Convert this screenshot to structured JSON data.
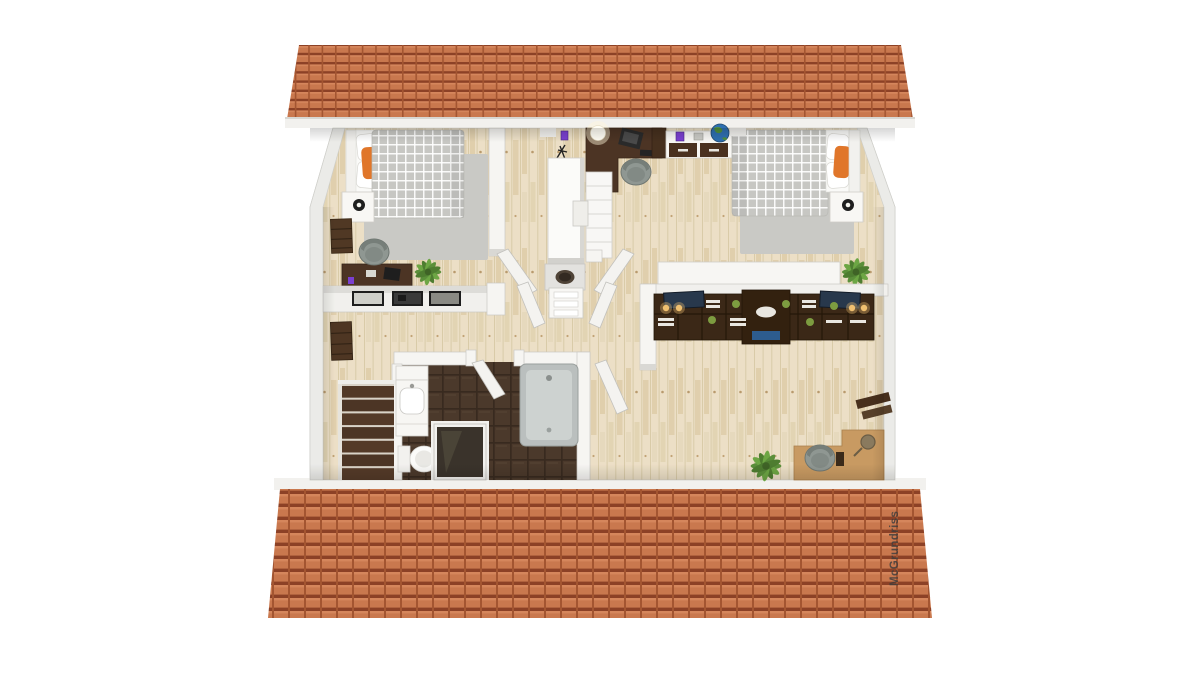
{
  "watermark": {
    "text": "McGrundriss"
  },
  "palette": {
    "background": "#ffffff",
    "roof_tile": "#c9784e",
    "roof_tile_light": "#d5865c",
    "roof_tile_shadow": "#8c4126",
    "roof_tile_seam": "#a35531",
    "fascia_white": "#f2f1ee",
    "wood_floor": "#ecdfc6",
    "wood_streak": "#d9cba8",
    "wall_white": "#f6f5f2",
    "wall_edge": "#c9c8c4",
    "outer_wall": "#ebebe8",
    "rug_gray": "#c9c9c5",
    "plaid_gray": "#c7c7c3",
    "bath_tile": "#4b392b",
    "bath_tile_line": "#382a1f",
    "tub_gray": "#babfbe",
    "dark_wood": "#4c3424",
    "shelf_wood": "#3b2817",
    "tan_desk": "#c89a62",
    "stair_wood": "#523927",
    "accent_orange": "#e0762a",
    "plant_green": "#5b8f3a",
    "plant_green_light": "#6da644",
    "chair_gray": "#8f9792",
    "globe_blue": "#2e6fb0",
    "gadget_purple": "#7a3fd0",
    "sconce_amber": "#f0c070",
    "picture_navy": "#28384c",
    "box_blue": "#2d5c8e"
  },
  "elements": [
    "top-roof-slope",
    "bottom-roof-slope",
    "roof-fascia",
    "wood-floor",
    "bedroom-left-bed",
    "bedroom-left-nightstand",
    "bedroom-left-lamp",
    "bedroom-left-rug",
    "bedroom-left-desk",
    "bedroom-left-chair",
    "picture-half-wall",
    "picture-frames",
    "ladder-shelf",
    "office-corner-desk",
    "office-laptop",
    "office-chair",
    "office-sideboard",
    "globe",
    "ceiling-lamp",
    "tall-wardrobe",
    "chimney",
    "hall-dresser",
    "bedroom-right-bed",
    "bedroom-right-nightstand",
    "bedroom-right-rug",
    "lowboard",
    "bookshelf-wall-unit",
    "sconce-lights",
    "bathroom-tile-floor",
    "vanity-sink",
    "toilet",
    "skylight-window",
    "bathtub",
    "staircase",
    "study-desk",
    "study-chair",
    "wall-shelf",
    "potted-plants",
    "door-leaves",
    "watermark-text"
  ]
}
